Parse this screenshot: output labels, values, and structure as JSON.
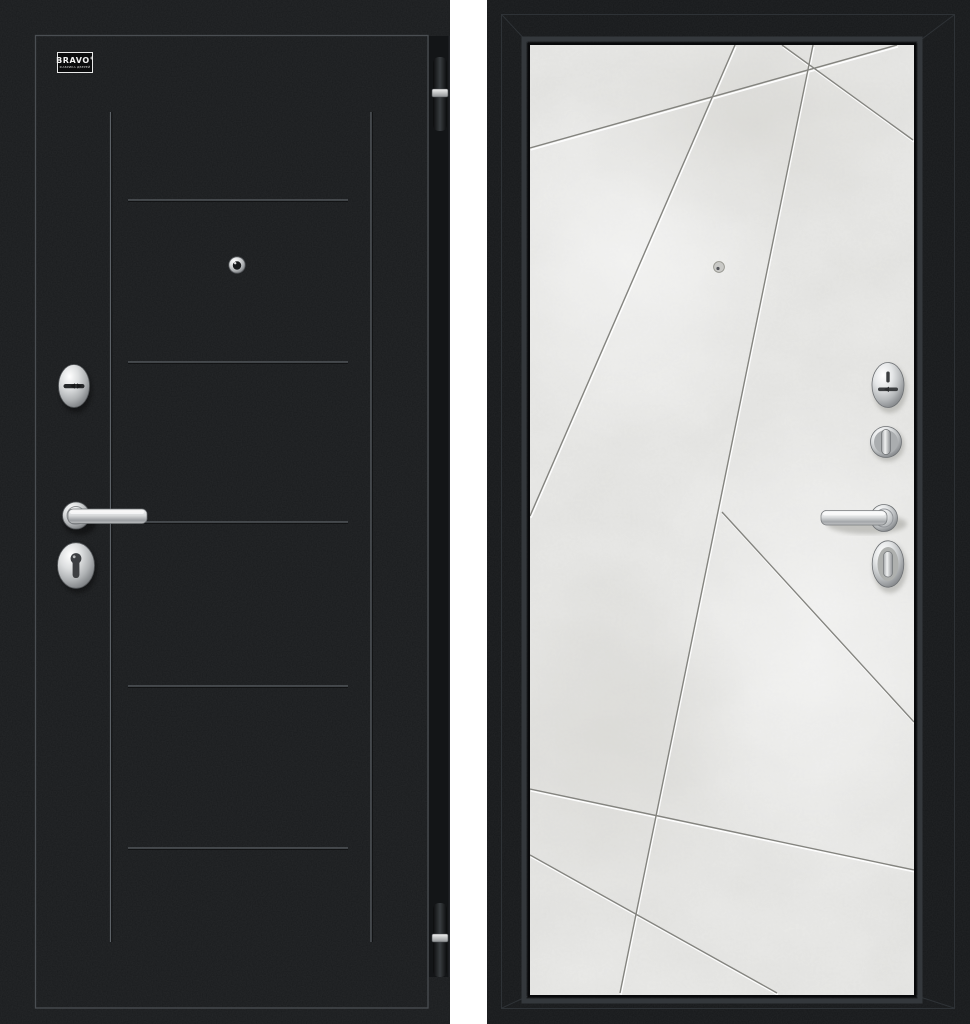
{
  "image": {
    "background_color": "#ffffff",
    "description_note": ""
  },
  "logo": {
    "brand": "BRAVO",
    "registered_mark": "®",
    "tagline": "ФАБРИКА ДВЕРЕЙ"
  },
  "left_door": {
    "finish_color": "#1a1c1e",
    "groove_color": "#5c6166",
    "outline_color": "#4a4e52",
    "edge_strip_color": "#131517",
    "hardware_finish": "#c6c8ca",
    "parts": {
      "peephole": "peephole",
      "upper_lock": "oval-keyhole-escutcheon",
      "handle": "chrome-lever-handle",
      "lower_lock": "oval-cylinder-escutcheon",
      "hinge_top": "barrel-hinge",
      "hinge_bottom": "barrel-hinge"
    }
  },
  "right_door": {
    "frame_color": "#17191b",
    "leaf_color": "#e9e9e7",
    "groove_dark": "#84847f",
    "groove_light": "#ffffff",
    "hardware_finish": "#d0d2d3",
    "parts": {
      "peephole": "peephole",
      "upper_lock": "oval-keyhole-escutcheon",
      "thumb_knob": "round-thumbturn-knob",
      "handle": "chrome-lever-handle",
      "lower_lock": "oval-thumbturn-escutcheon"
    }
  }
}
